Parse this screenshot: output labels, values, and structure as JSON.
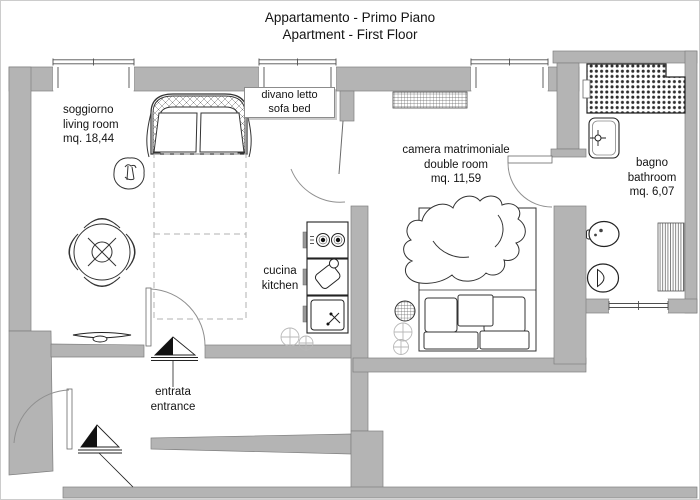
{
  "title": {
    "line1": "Appartamento - Primo Piano",
    "line2": "Apartment - First Floor"
  },
  "labels": {
    "living": {
      "l1": "soggiorno",
      "l2": "living room",
      "l3": "mq. 18,44"
    },
    "sofa_bed": {
      "l1": "divano letto",
      "l2": "sofa bed"
    },
    "bedroom": {
      "l1": "camera matrimoniale",
      "l2": "double room",
      "l3": "mq. 11,59"
    },
    "bathroom": {
      "l1": "bagno",
      "l2": "bathroom",
      "l3": "mq. 6,07"
    },
    "kitchen": {
      "l1": "cucina",
      "l2": "kitchen"
    },
    "entrance": {
      "l1": "entrata",
      "l2": "entrance"
    }
  },
  "colors": {
    "wall": "#b4b4b4",
    "line": "#3d3d3d",
    "text": "#141414",
    "background": "#ffffff",
    "border": "#cccccc"
  }
}
